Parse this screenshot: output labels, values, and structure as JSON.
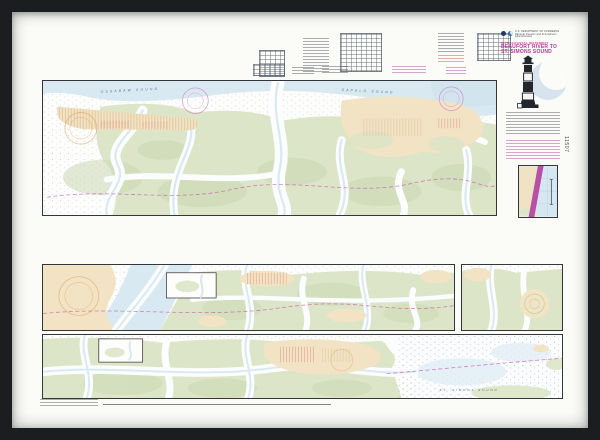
{
  "frame": {
    "material_color": "#1b1d20",
    "matte_color": "#fbfbf8"
  },
  "chart": {
    "edge_number": "11507",
    "header": {
      "agency_line1": "U.S. DEPARTMENT OF COMMERCE",
      "agency_line2": "National Oceanic and Atmospheric Administration",
      "series_title": "INTRACOASTAL WATERWAY",
      "title_line1": "BEAUFORT RIVER TO",
      "title_line2": "ST. SIMONS SOUND"
    },
    "labels": {
      "sound_nw": "OSSABAW SOUND",
      "sound_ne": "SAPELO SOUND",
      "sound_s": "ST. SIMONS SOUND"
    },
    "colors": {
      "title_magenta": "#b5399e",
      "icw_route_magenta": "#c23aa6",
      "marsh_green": "#dce5c7",
      "land_tan": "#f2e3c4",
      "water_blue": "#d9e9f1",
      "compass_rose_orange": "#d99b55"
    }
  }
}
